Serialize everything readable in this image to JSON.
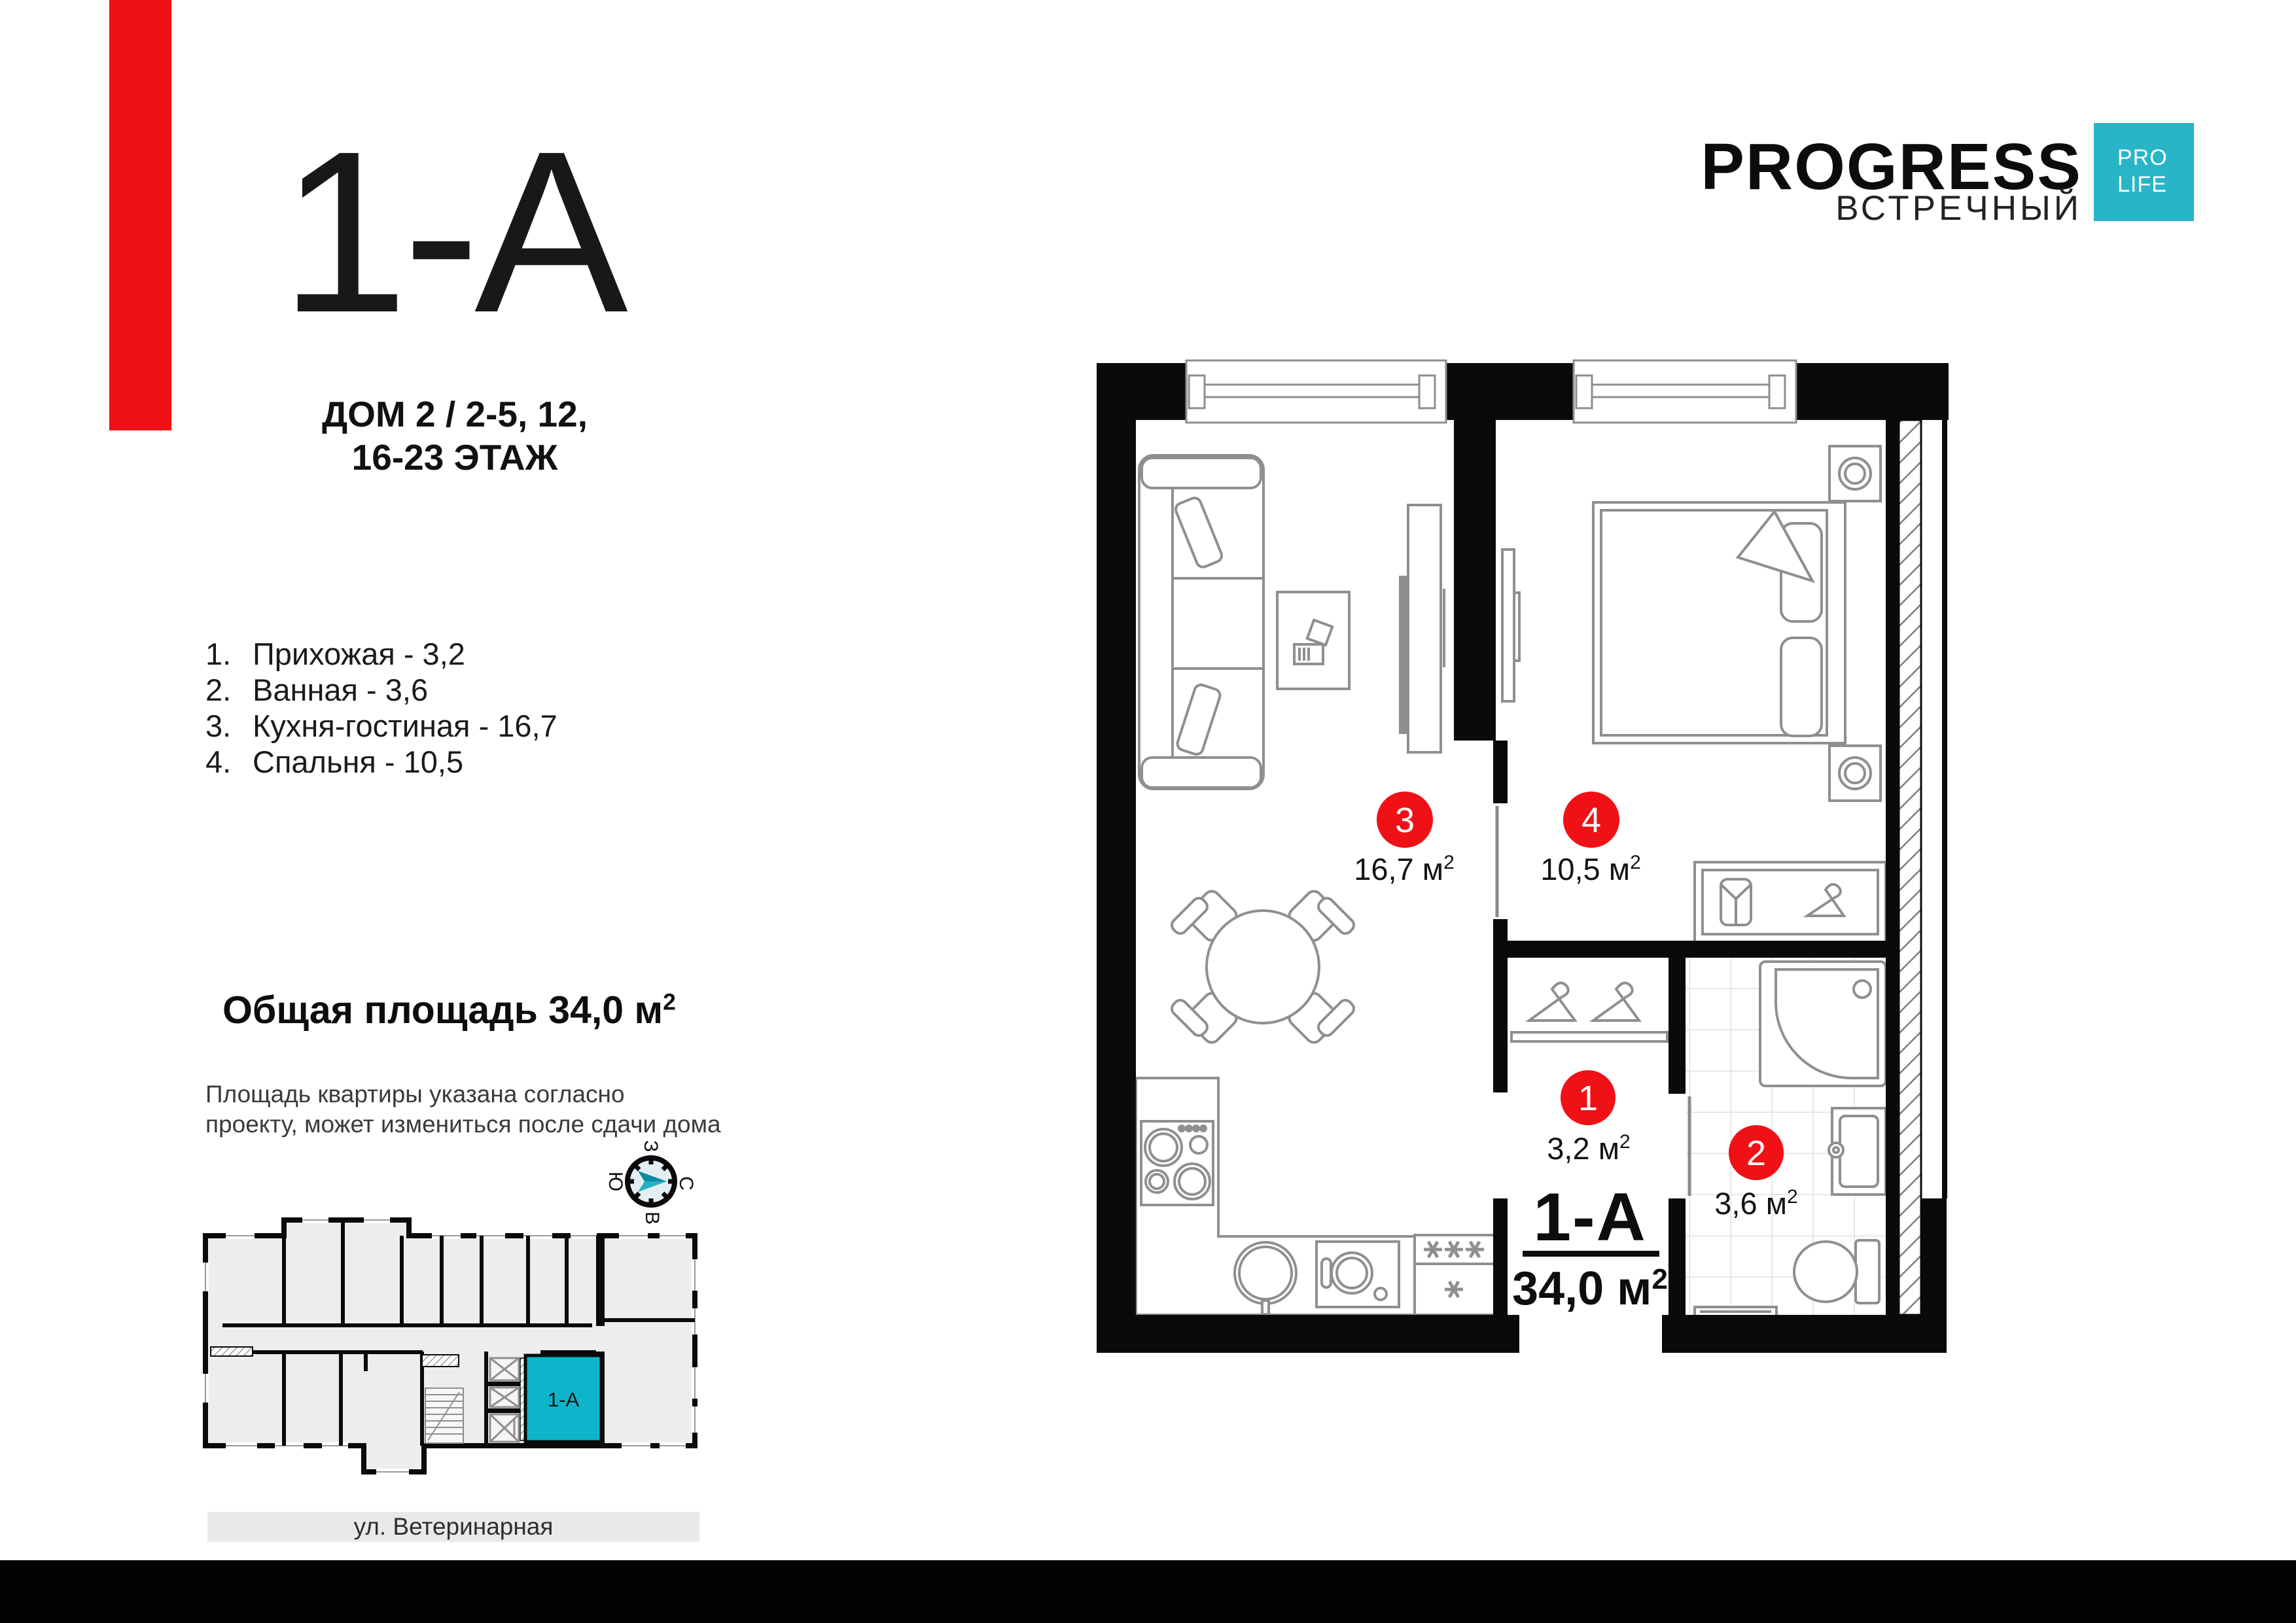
{
  "colors": {
    "accent_red": "#f01116",
    "brand_teal": "#29b5c8",
    "unit_cyan": "#0eb5ca",
    "wall_black": "#0a0a0a",
    "furniture_gray": "#8f8f8f"
  },
  "title_block": {
    "unit_code": "1-А",
    "building_line1": "ДОМ 2 / 2-5, 12,",
    "building_line2": "16-23 ЭТАЖ"
  },
  "room_list": {
    "items": [
      {
        "num": "1.",
        "label": "Прихожая - 3,2"
      },
      {
        "num": "2.",
        "label": "Ванная - 3,6"
      },
      {
        "num": "3.",
        "label": "Кухня-гостиная - 16,7"
      },
      {
        "num": "4.",
        "label": "Спальня - 10,5"
      }
    ]
  },
  "total_area": {
    "text": "Общая площадь 34,0 м",
    "sup": "2"
  },
  "disclaimer": {
    "line1": "Площадь квартиры указана согласно",
    "line2": "проекту, может измениться после сдачи дома"
  },
  "compass": {
    "west": "З",
    "north": "С",
    "south": "Ю",
    "east": "В"
  },
  "logo": {
    "brand": "PROGRESS",
    "project": "ВСТРЕЧНЫЙ",
    "badge_line1": "PRO",
    "badge_line2": "LIFE"
  },
  "floor_plan": {
    "room1": {
      "number": "1",
      "area": "3,2 м",
      "sup": "2"
    },
    "room2": {
      "number": "2",
      "area": "3,6 м",
      "sup": "2"
    },
    "room3": {
      "number": "3",
      "area": "16,7 м",
      "sup": "2"
    },
    "room4": {
      "number": "4",
      "area": "10,5 м",
      "sup": "2"
    },
    "unit_code": "1-А",
    "unit_area": {
      "text": "34,0 м",
      "sup": "2"
    }
  },
  "mini_plan": {
    "unit_label": "1-А",
    "street": "ул. Ветеринарная"
  }
}
